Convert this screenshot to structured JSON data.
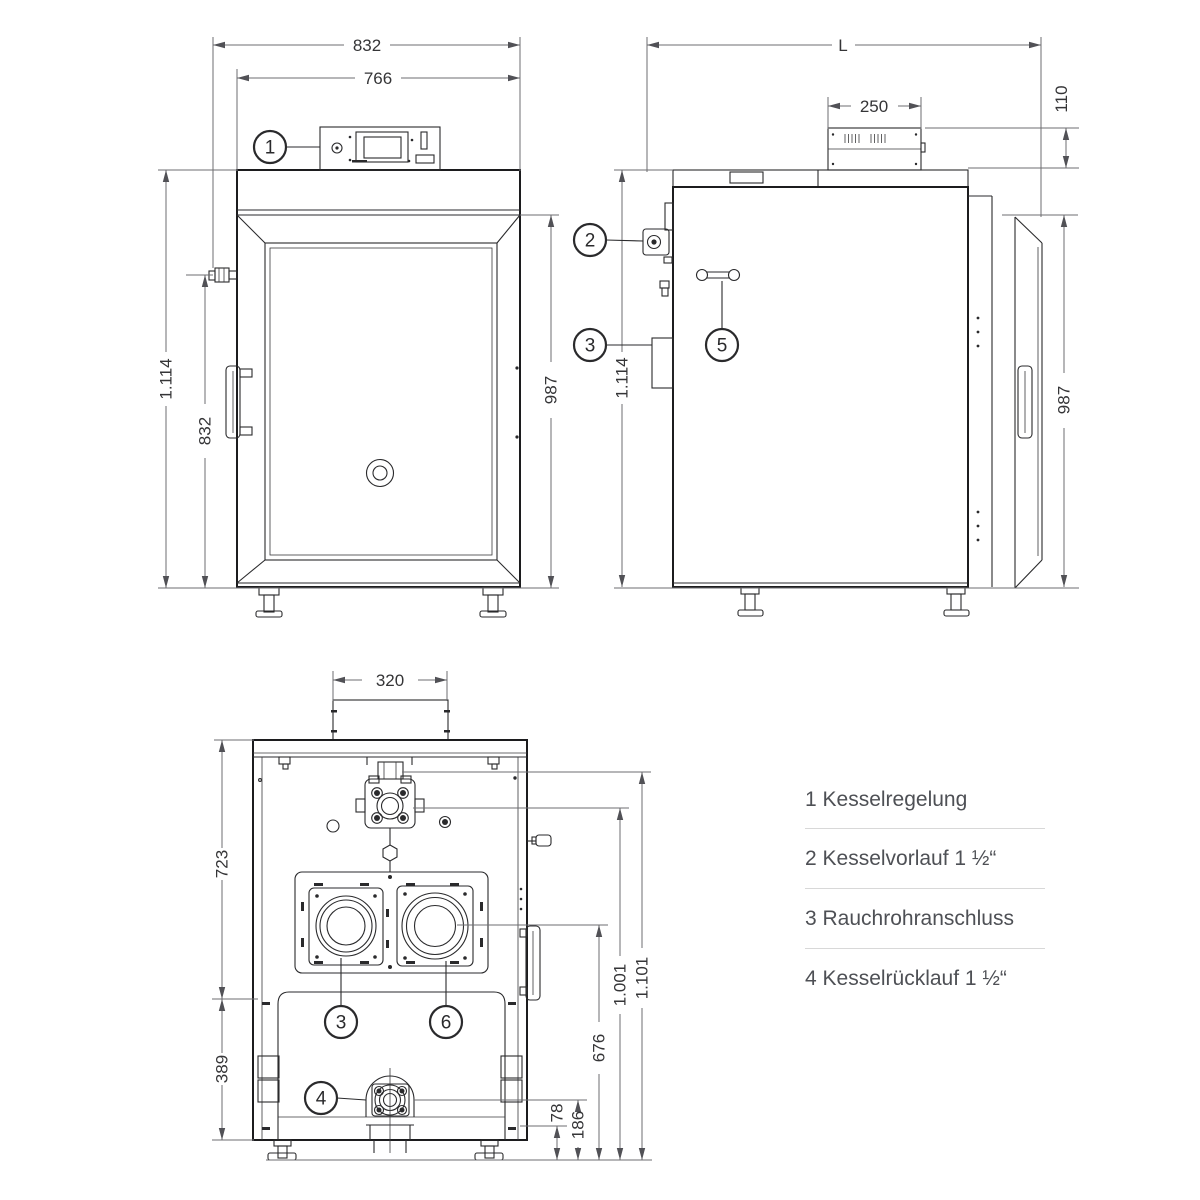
{
  "colors": {
    "background": "#ffffff",
    "drawing_line": "#2a2a2c",
    "dimension_line": "#6d6d71",
    "dimension_text": "#353537",
    "legend_text": "#4e5055",
    "divider": "#d8d8d8"
  },
  "views": {
    "front": {
      "dims": {
        "overall_width": "832",
        "body_width": "766",
        "overall_height": "1.114",
        "fitting_height": "832",
        "door_height": "987"
      },
      "callouts": {
        "c1": "1"
      }
    },
    "side": {
      "dims": {
        "length": "L",
        "control_unit_width": "250",
        "control_unit_height": "110",
        "overall_height": "1.114",
        "door_height": "987"
      },
      "callouts": {
        "c2": "2",
        "c3": "3",
        "c5": "5"
      }
    },
    "rear": {
      "dims": {
        "flue_duct_width": "320",
        "upper_height": "723",
        "lower_height": "389",
        "base_height": "78",
        "return_height": "186",
        "flue_height": "676",
        "flow_height": "1.001",
        "overall_height": "1.101"
      },
      "callouts": {
        "c3": "3",
        "c6": "6",
        "c4": "4"
      }
    }
  },
  "legend": {
    "items": [
      {
        "text": "1 Kesselregelung"
      },
      {
        "text": "2 Kesselvorlauf 1 ½“"
      },
      {
        "text": "3 Rauchrohranschluss"
      },
      {
        "text": "4 Kesselrücklauf 1 ½“"
      }
    ]
  }
}
